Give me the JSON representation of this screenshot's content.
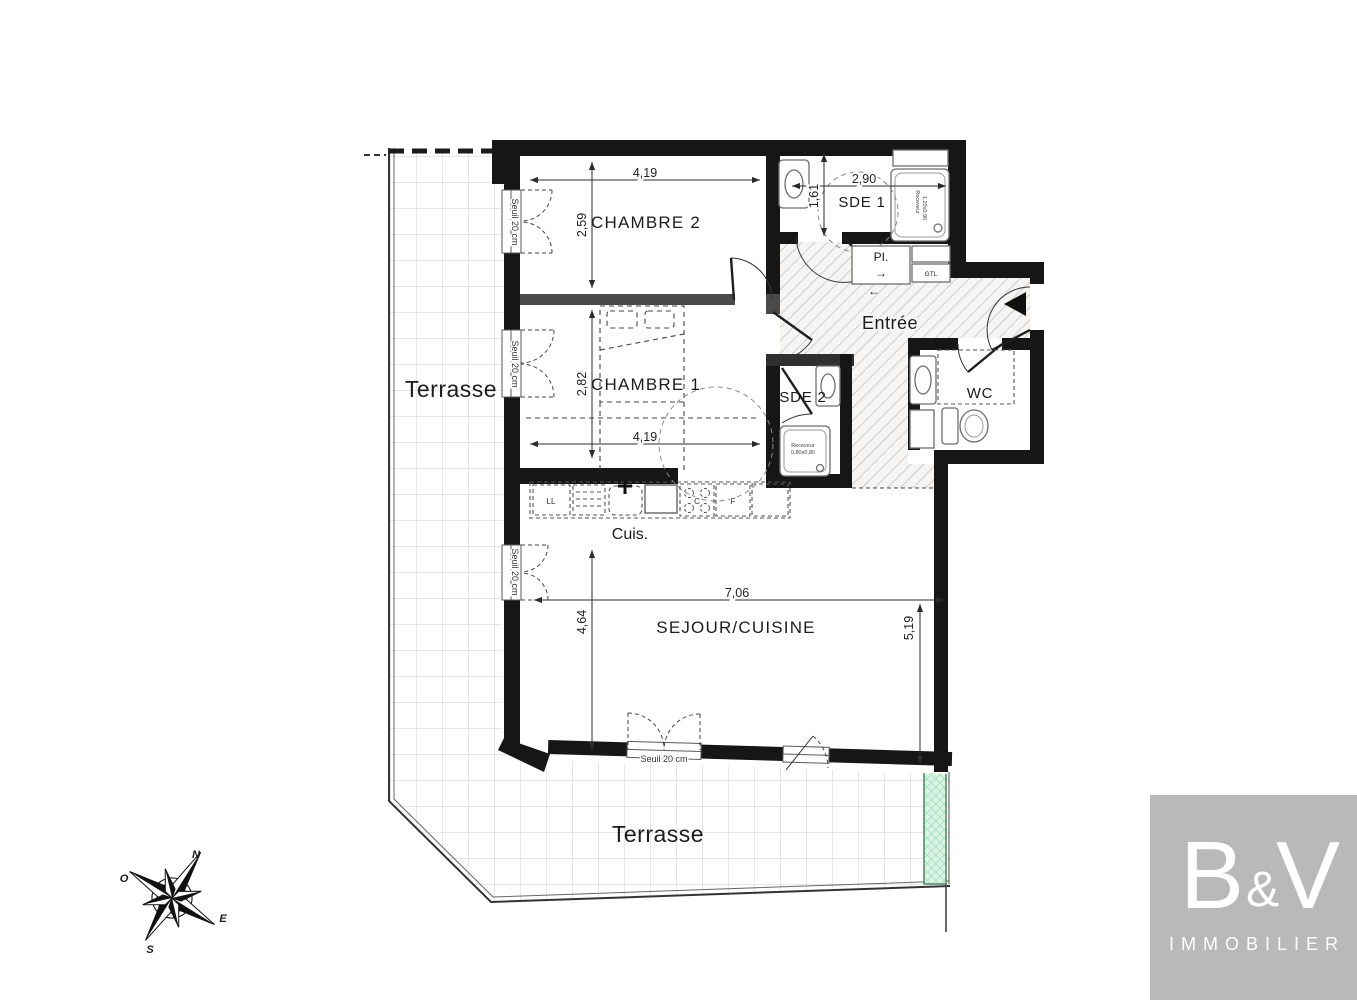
{
  "colors": {
    "wall": "#161616",
    "terrace_grid": "#cfcfcf",
    "hatch": "#bdbdbd",
    "green_element": "#7ecf9f",
    "logo_bg": "#b9b9b9"
  },
  "terrace": {
    "left_label": "Terrasse",
    "bottom_label": "Terrasse"
  },
  "rooms": {
    "chambre2": {
      "name": "CHAMBRE 2",
      "width": "4,19",
      "height": "2,59"
    },
    "chambre1": {
      "name": "CHAMBRE 1",
      "width": "4,19",
      "height": "2,82"
    },
    "sde1": {
      "name": "SDE 1",
      "width": "2,90",
      "height": "1,61",
      "receveur_line1": "Receveur",
      "receveur_line2": "1,20x0,90"
    },
    "sde2": {
      "name": "SDE 2",
      "receveur_line1": "Receveur",
      "receveur_line2": "0,80x0,80"
    },
    "wc": {
      "name": "WC"
    },
    "entree": {
      "name": "Entrée"
    },
    "sejour": {
      "name": "SEJOUR/CUISINE",
      "width": "7,06",
      "height_right": "5,19",
      "height_left": "4,64"
    },
    "cuisine": {
      "name": "Cuis.",
      "washer": "LL",
      "cooktop": "C",
      "oven": "F"
    },
    "placard": {
      "name": "PI.",
      "arrow_right": "→",
      "arrow_left": "←",
      "gtl": "GTL"
    }
  },
  "thresholds": {
    "label": "Seuil 20 cm"
  },
  "compass": {
    "north": "N",
    "west": "O",
    "east": "E",
    "south": "S"
  },
  "logo": {
    "b": "B",
    "amp": "&",
    "v": "V",
    "subtitle": "IMMOBILIER"
  }
}
